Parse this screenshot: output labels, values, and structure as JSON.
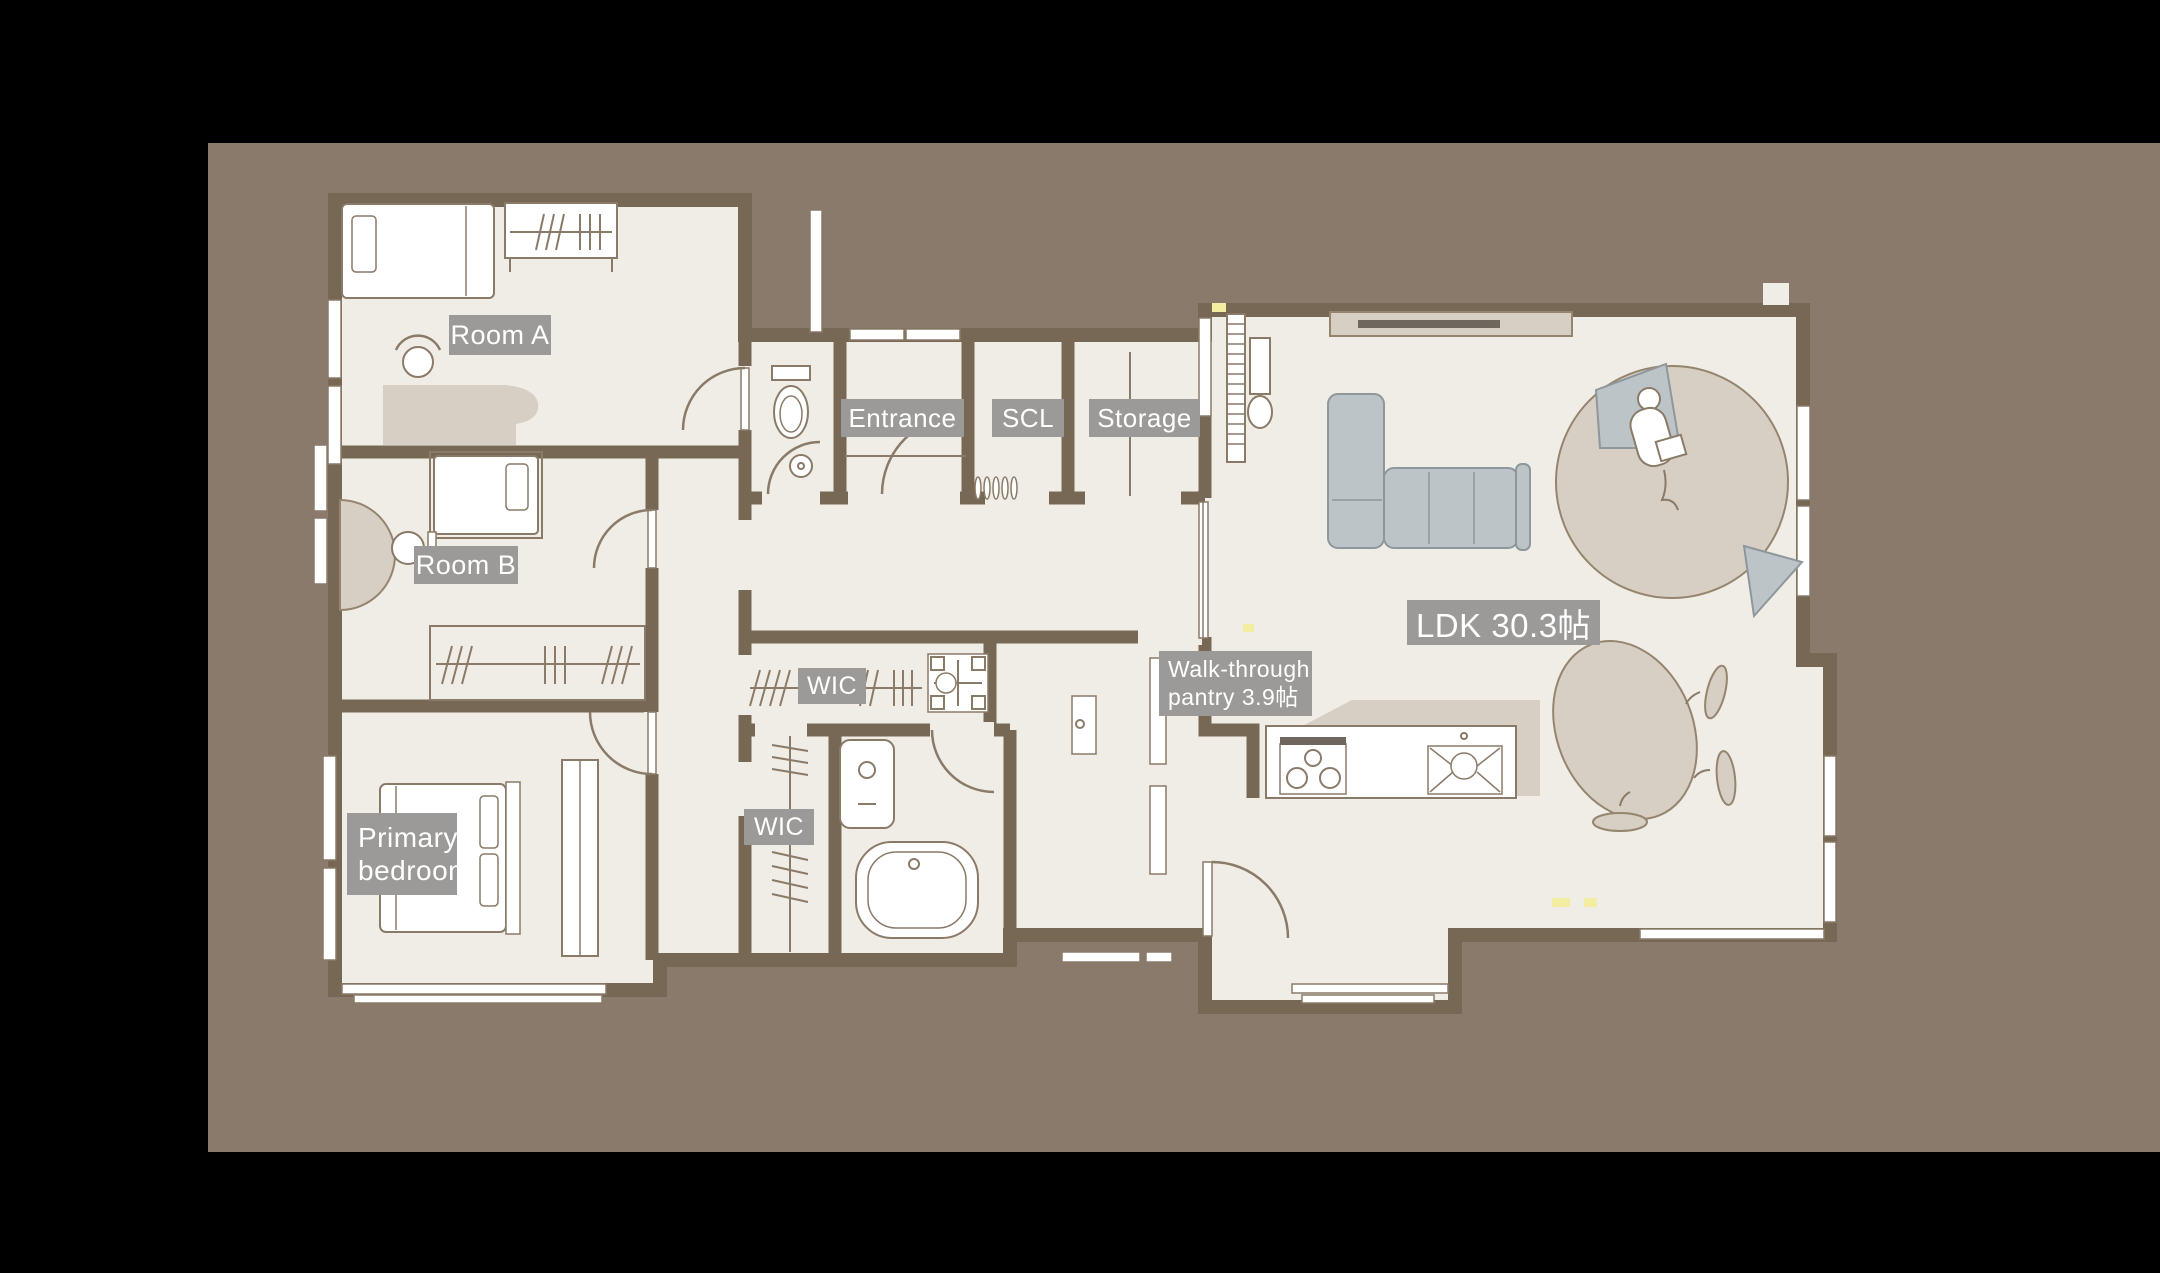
{
  "theme": {
    "bg": "#000000",
    "canvas": "#8a7a6c",
    "floor": "#f0ede6",
    "wall": "#776855",
    "line": "#8a7a68",
    "labelbg": "#9b9a98",
    "labeltext": "#ffffff",
    "gray": "#bdc4c8",
    "grayline": "#8e979c",
    "beige": "#d7cec4",
    "beigeline": "#95856f",
    "white": "#ffffff",
    "yellow": "#f2eda1",
    "tv": "#6f675d"
  },
  "labels": {
    "room_a": "Room A",
    "room_b": "Room B",
    "entrance": "Entrance",
    "scl": "SCL",
    "storage": "Storage",
    "ldk": "LDK 30.3帖",
    "pantry": "Walk-through\npantry 3.9帖",
    "wic_upper": "WIC",
    "wic_lower": "WIC",
    "primary_bedroom": "Primary\nbedroom"
  }
}
